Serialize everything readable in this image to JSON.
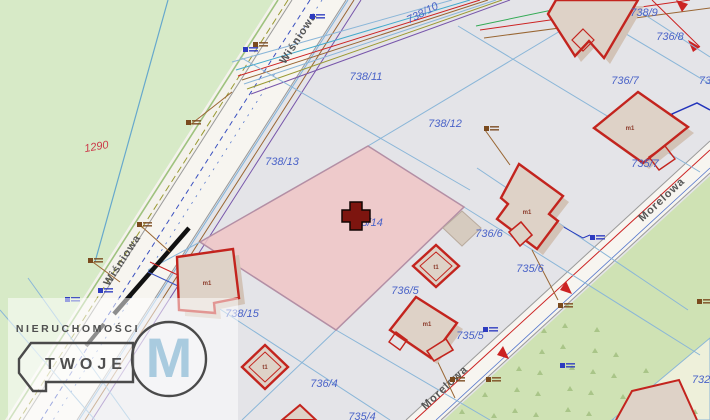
{
  "map": {
    "type": "cadastral-map",
    "selected_parcel": "738/14",
    "colors": {
      "bg": "#e4e4e8",
      "greenLeft": "#d7eac7",
      "greenRight": "#cfe2b4",
      "triangleGreen": "#a2bf80",
      "beige": "#eef0da",
      "roadFill": "#f7f5f0",
      "parcelLine": "#8ab6d8",
      "labelBlue": "#4a63c8",
      "labelRed": "#cc3a4a",
      "pinkFill": "#f0c6c6",
      "pinkEdge": "#b38fa5",
      "bldgFill": "#ded2c7",
      "bldgShadow": "#d2c3b7",
      "bldgStroke": "#c3241e",
      "crossFill": "#7d150f",
      "wmBlue": "#a9cbdf"
    },
    "parcel_labels": [
      {
        "text": "738/10",
        "x": 424,
        "y": 12,
        "r": -27
      },
      {
        "text": "738/9",
        "x": 644,
        "y": 12,
        "r": 0
      },
      {
        "text": "736/8",
        "x": 670,
        "y": 36,
        "r": 0
      },
      {
        "text": "736/7",
        "x": 625,
        "y": 80,
        "r": 0
      },
      {
        "text": "73",
        "x": 705,
        "y": 80,
        "r": 0
      },
      {
        "text": "735/7",
        "x": 645,
        "y": 163,
        "r": 0
      },
      {
        "text": "738/11",
        "x": 366,
        "y": 76,
        "r": 0
      },
      {
        "text": "738/12",
        "x": 445,
        "y": 123,
        "r": 0
      },
      {
        "text": "738/13",
        "x": 282,
        "y": 161,
        "r": 0
      },
      {
        "text": "738/14",
        "x": 366,
        "y": 222,
        "r": 0
      },
      {
        "text": "736/6",
        "x": 489,
        "y": 233,
        "r": 0
      },
      {
        "text": "735/6",
        "x": 530,
        "y": 268,
        "r": 0
      },
      {
        "text": "736/5",
        "x": 405,
        "y": 290,
        "r": 0
      },
      {
        "text": "735/5",
        "x": 470,
        "y": 335,
        "r": 0
      },
      {
        "text": "738/15",
        "x": 242,
        "y": 313,
        "r": 0
      },
      {
        "text": "736/4",
        "x": 324,
        "y": 383,
        "r": 0
      },
      {
        "text": "735/4",
        "x": 362,
        "y": 416,
        "r": 0
      },
      {
        "text": "732",
        "x": 701,
        "y": 379,
        "r": 0
      },
      {
        "text": "1290",
        "x": 97,
        "y": 146,
        "r": -10,
        "red": true
      }
    ],
    "street_labels": [
      {
        "text": "Wiśniowa",
        "x": 301,
        "y": 40,
        "r": -57
      },
      {
        "text": "Wiśniowa",
        "x": 125,
        "y": 262,
        "r": -57
      },
      {
        "text": "Morelowa",
        "x": 664,
        "y": 202,
        "r": -43
      },
      {
        "text": "Morelowa",
        "x": 447,
        "y": 390,
        "r": -43
      }
    ],
    "building_labels": [
      {
        "text": "m1",
        "x": 630,
        "y": 130
      },
      {
        "text": "m1",
        "x": 527,
        "y": 214
      },
      {
        "text": "m1",
        "x": 207,
        "y": 285
      },
      {
        "text": "m1",
        "x": 427,
        "y": 326
      },
      {
        "text": "t1",
        "x": 436,
        "y": 269
      },
      {
        "text": "t1",
        "x": 265,
        "y": 369
      }
    ],
    "utility_symbols": [
      {
        "x": 186,
        "y": 120,
        "kind": "brown"
      },
      {
        "x": 484,
        "y": 126,
        "kind": "brown"
      },
      {
        "x": 137,
        "y": 222,
        "kind": "brown"
      },
      {
        "x": 88,
        "y": 258,
        "kind": "brown"
      },
      {
        "x": 558,
        "y": 303,
        "kind": "brown"
      },
      {
        "x": 486,
        "y": 377,
        "kind": "brown"
      },
      {
        "x": 450,
        "y": 377,
        "kind": "brown"
      },
      {
        "x": 253,
        "y": 42,
        "kind": "brown"
      },
      {
        "x": 697,
        "y": 299,
        "kind": "brown"
      },
      {
        "x": 65,
        "y": 297,
        "kind": "blue"
      },
      {
        "x": 98,
        "y": 288,
        "kind": "blue"
      },
      {
        "x": 483,
        "y": 327,
        "kind": "blue"
      },
      {
        "x": 590,
        "y": 235,
        "kind": "blue"
      },
      {
        "x": 310,
        "y": 14,
        "kind": "blue"
      },
      {
        "x": 243,
        "y": 47,
        "kind": "blue"
      },
      {
        "x": 560,
        "y": 363,
        "kind": "blue"
      }
    ],
    "watermark": {
      "line1": "NIERUCHOMOŚCI",
      "line2": "TWOJE",
      "letter": "M"
    }
  }
}
